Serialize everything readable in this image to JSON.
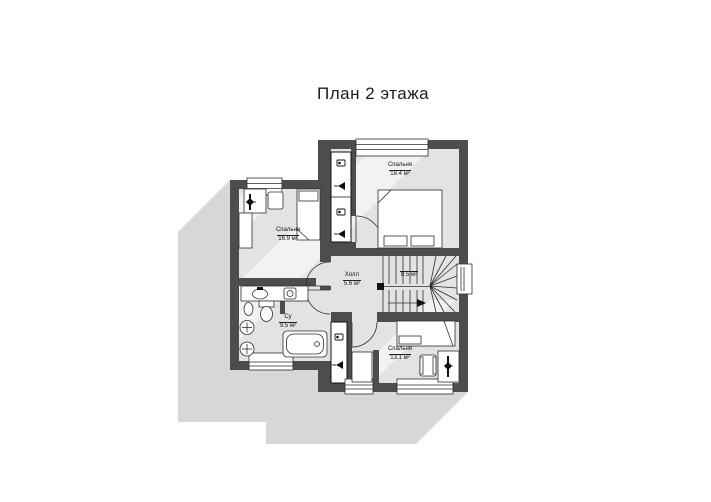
{
  "title": "План 2 этажа",
  "rooms": [
    {
      "name": "Спальня",
      "area": "18.4 м²"
    },
    {
      "name": "Спальня",
      "area": "16.9 м²"
    },
    {
      "name": "Су",
      "area": "9.5 м²"
    },
    {
      "name": "Холл",
      "area": "5.6 м²"
    },
    {
      "name": "",
      "area": "8.5 м²"
    },
    {
      "name": "Спальня",
      "area": "13.1 м²"
    }
  ],
  "icons": {
    "vent_duct": "ventilation-duct symbol (box with dot)",
    "smoke_duct": "smoke-duct symbol (filled triangle)",
    "stair_arrow": "descent direction arrow"
  },
  "colors": {
    "wall": "#4d4d4d",
    "floor": "#e3e3e3",
    "shadow": "#d7d7d7",
    "line": "#2e2e2e",
    "background": "#ffffff"
  }
}
